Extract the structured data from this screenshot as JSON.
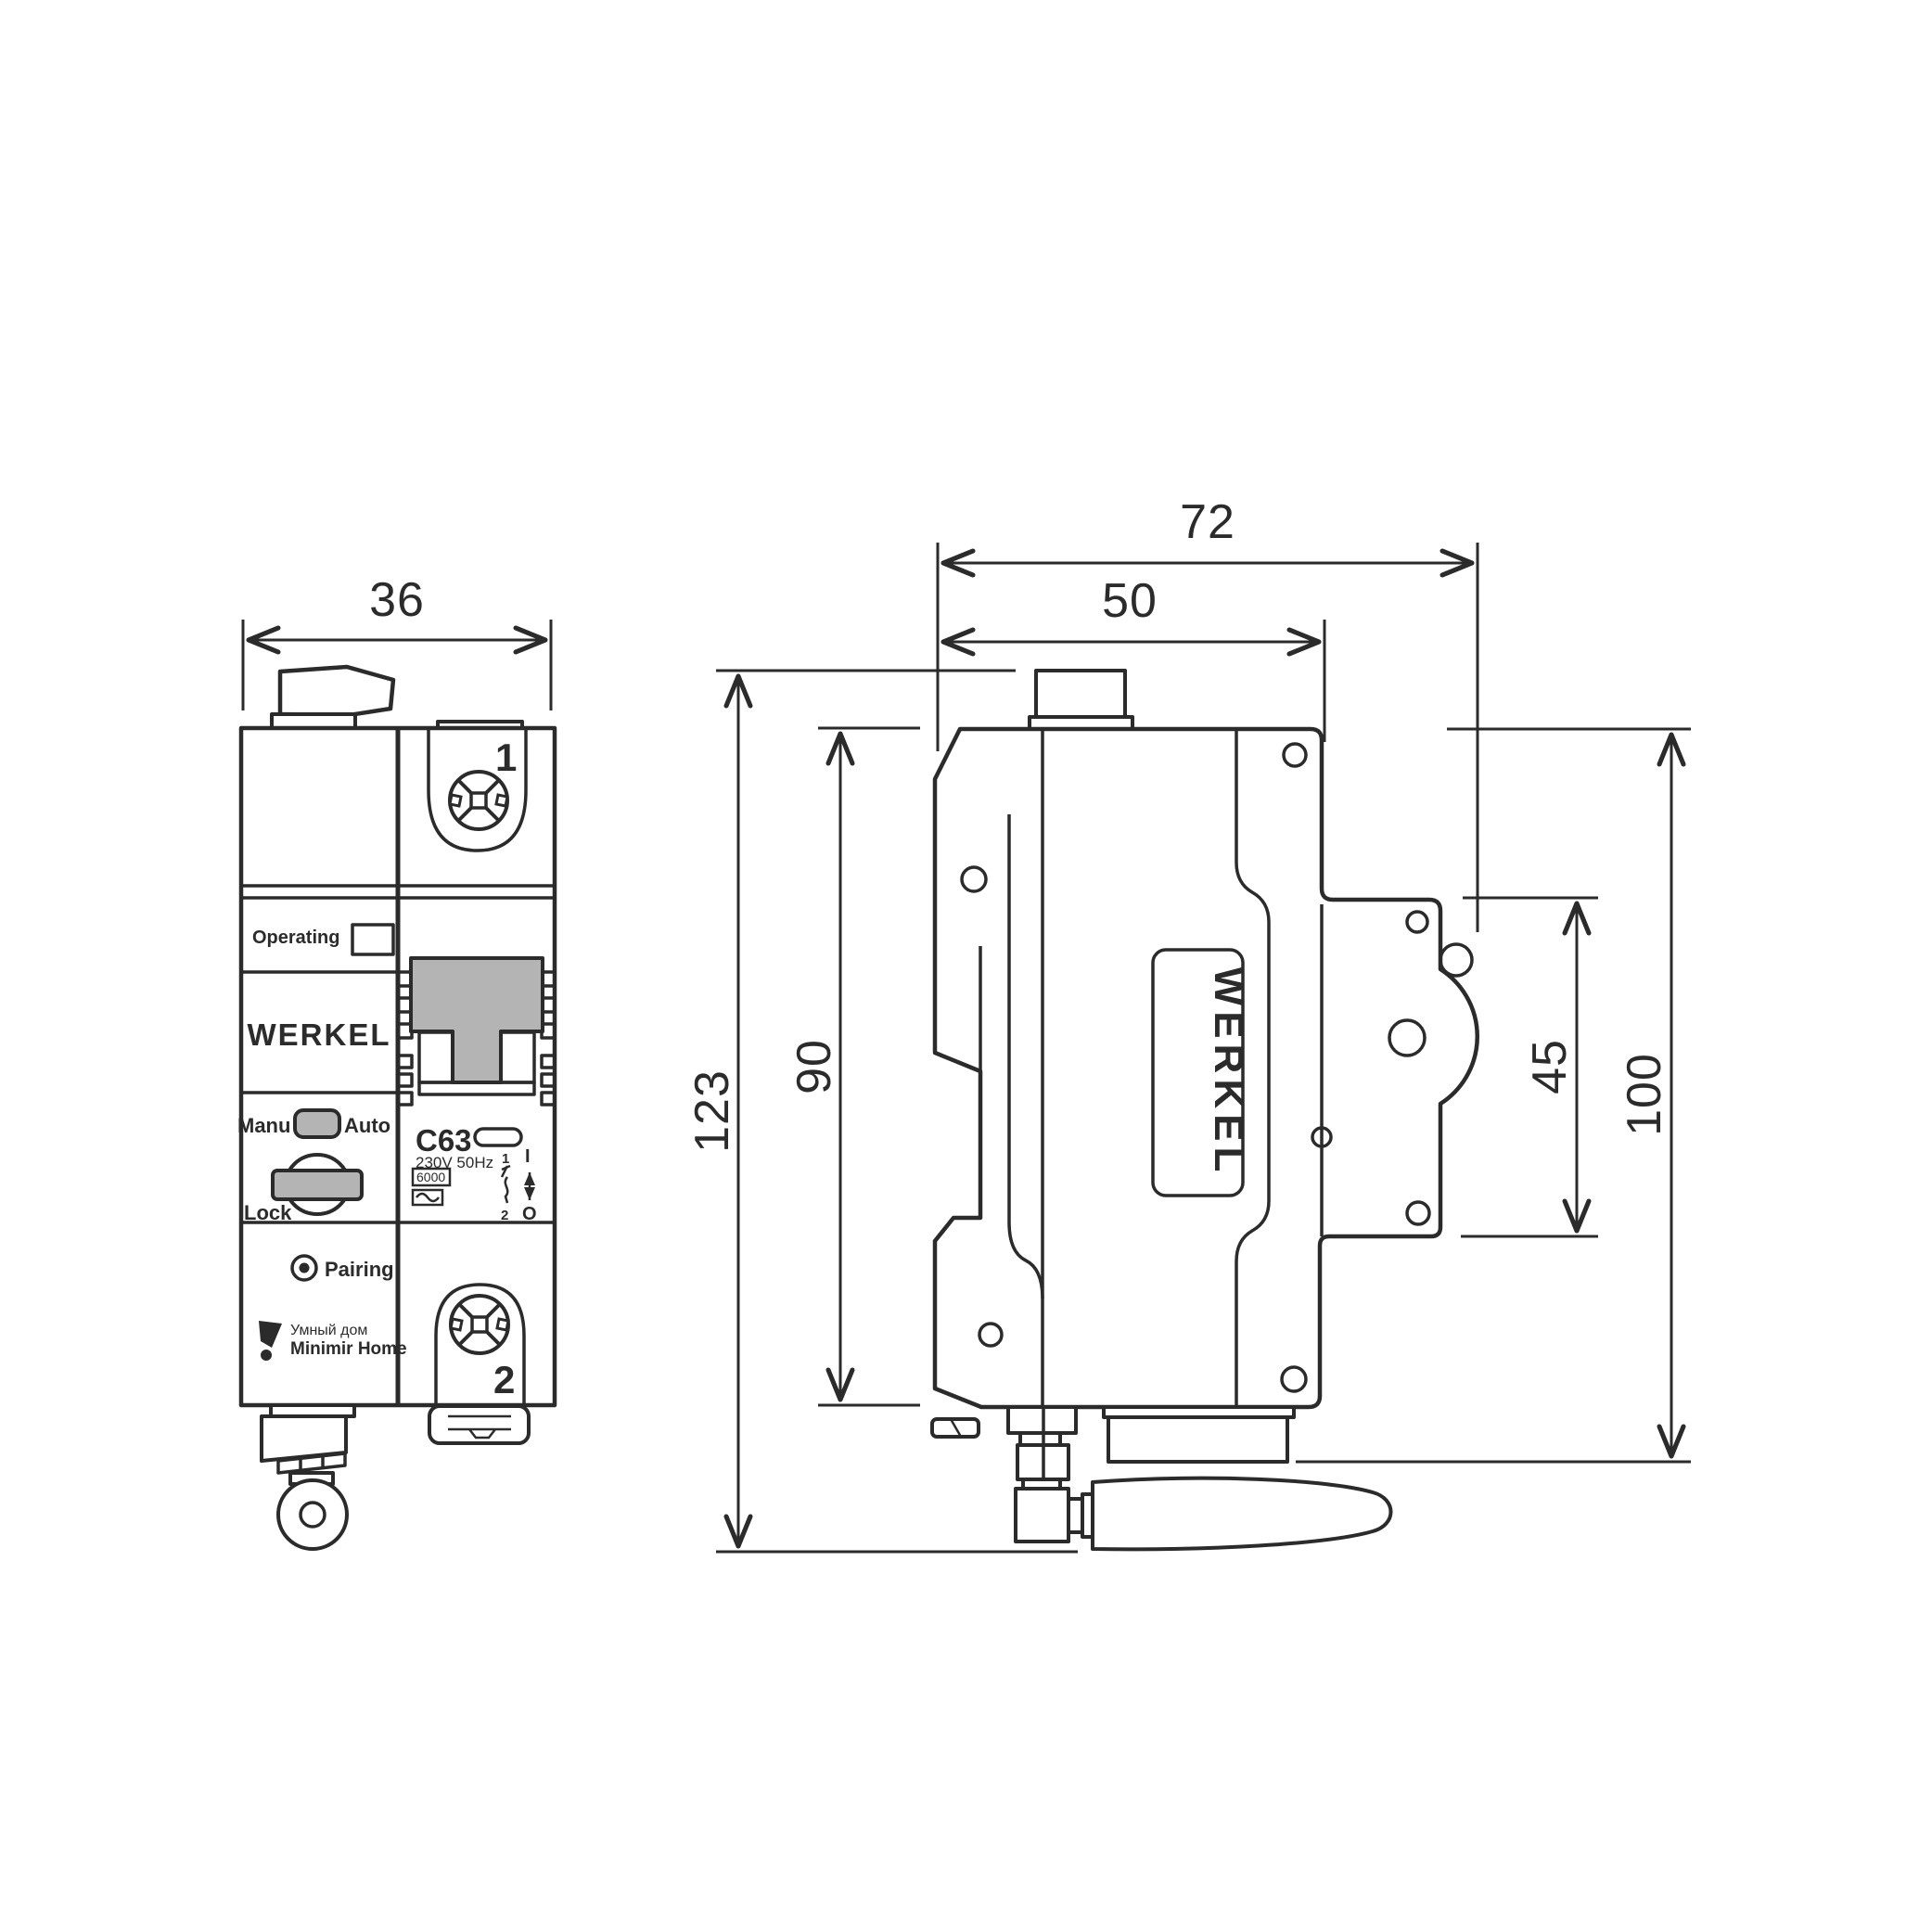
{
  "drawing": {
    "title": "Werkel smart circuit breaker dimensional drawing",
    "colors": {
      "line": "#2b2b2b",
      "gray_fill": "#b4b4b4",
      "background": "#ffffff"
    },
    "dimensions": {
      "front_width": "36",
      "side_total_width": "72",
      "side_body_width": "50",
      "total_height": "123",
      "body_height": "90",
      "terminal_block_height": "45",
      "mount_height": "100"
    },
    "front_view": {
      "labels": {
        "operating": "Operating",
        "brand": "WERKEL",
        "manu": "Manu",
        "auto": "Auto",
        "lock": "Lock",
        "pairing": "Pairing",
        "smart_home_line1": "Умный дом",
        "smart_home_line2": "Minimir Home",
        "terminal_top": "1",
        "terminal_bottom": "2",
        "rating": "C63",
        "voltage": "230V 50Hz",
        "breaking_capacity": "6000",
        "diagram_pole_top": "1",
        "diagram_pole_bottom": "2",
        "switch_on": "I",
        "switch_off": "O"
      },
      "icons": {
        "terminal_screw": "pozidriv-screw-icon",
        "pairing_led": "led-target-icon",
        "smart_home_logo": "flag-logo-icon",
        "sine": "sine-wave-icon"
      }
    },
    "side_view": {
      "labels": {
        "brand": "WERKEL"
      }
    }
  }
}
